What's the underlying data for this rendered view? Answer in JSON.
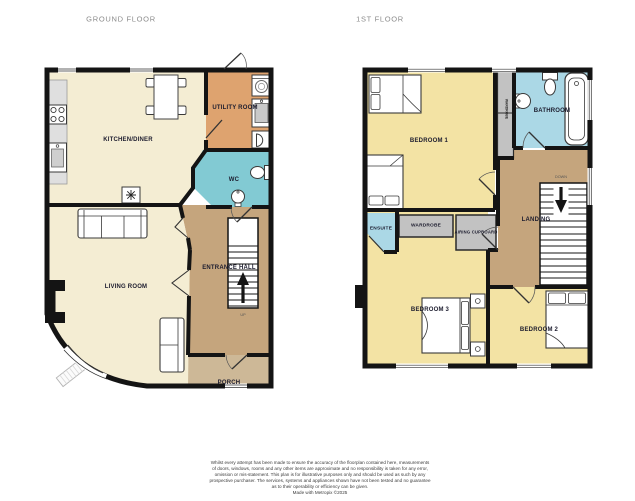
{
  "headers": {
    "ground_floor": "GROUND FLOOR",
    "first_floor": "1ST FLOOR"
  },
  "ground_floor": {
    "rooms": {
      "kitchen_diner": "KITCHEN/DINER",
      "utility_room": "UTILITY ROOM",
      "wc": "WC",
      "entrance_hall": "ENTRANCE HALL",
      "living_room": "LIVING ROOM",
      "porch": "PORCH"
    },
    "stairs_direction": "UP"
  },
  "first_floor": {
    "rooms": {
      "bedroom_1": "BEDROOM 1",
      "bathroom": "BATHROOM",
      "landing": "LANDING",
      "ensuite": "ENSUITE",
      "wardrobe": "WARDROBE",
      "airing_cupboard": "AIRING CUPBOARD",
      "bedroom_3": "BEDROOM 3",
      "bedroom_2": "BEDROOM 2",
      "built_in_wardrobe": "WARDROBE"
    },
    "stairs_direction": "DOWN"
  },
  "disclaimer": {
    "lines": [
      "Whilst every attempt has been made to ensure the accuracy of the floorplan contained here, measurements",
      "of doors, windows, rooms and any other items are approximate and no responsibility is taken for any error,",
      "omission or mis-statement. This plan is for illustrative purposes only and should be used as such by any",
      "prospective purchaser. The services, systems and appliances shown have not been tested and no guarantee",
      "as to their operability or efficiency can be given.",
      "Made with Metropix ©2025"
    ]
  },
  "colors": {
    "wall": "#141414",
    "kitchen_living": "#F4EDD3",
    "bedroom": "#F3E3A4",
    "utility": "#DEA36F",
    "hall_landing": "#C5A57D",
    "porch": "#CDB897",
    "wc": "#82CAD3",
    "bathroom_ensuite": "#ABD8E6",
    "cupboard": "#C2C2C2"
  },
  "icons": [
    "hob-icon",
    "kitchen-sink-icon",
    "freezer-icon",
    "dining-table-icon",
    "sofa-icon",
    "armchair-icon",
    "rug-icon",
    "fireplace-icon",
    "bay-window-icon",
    "washing-machine-icon",
    "utility-sink-icon",
    "boiler-icon",
    "toilet-icon",
    "basin-icon",
    "stairs-up-icon",
    "stairs-down-icon",
    "bed-icon",
    "bathtub-icon",
    "nightstand-icon",
    "door-swing-icon",
    "window-icon"
  ]
}
